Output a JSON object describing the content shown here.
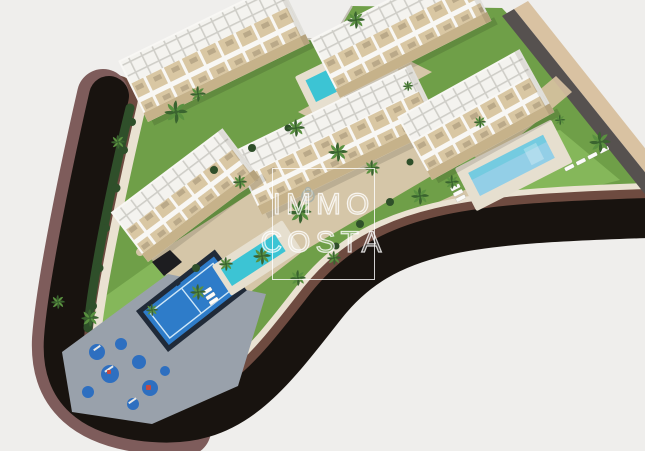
{
  "watermark": {
    "line1": "IMMO",
    "line2": "COSTA"
  },
  "palette": {
    "background": "#efeeec",
    "road-asphalt": "#18130f",
    "curb-maroon": "#7e5c5b",
    "curb-brown": "#6e4b40",
    "sidewalk-cream": "#eae2d2",
    "lawn-green": "#6f9f48",
    "lawn-light": "#85b75a",
    "hedge-dark": "#2f4f2a",
    "building-white": "#f8f7f4",
    "terrace-tan": "#d9c7a3",
    "stone-base": "#c6b28a",
    "plaza-tan": "#d5c6a8",
    "deck-cream": "#e6dfcf",
    "paving-gray": "#99a1ab",
    "pool-turquoise": "#3cc4d4",
    "pool-light": "#93cfe7",
    "padel-blue": "#2e7cc9",
    "padel-frame": "#202a38",
    "play-circle-blue": "#2e6fc0",
    "palm-dark": "#3a642f",
    "palm-light": "#5a9140",
    "trunk-brown": "#8a6a4c",
    "wall-dark": "#56514f",
    "wall-tan": "#d9c2a2"
  },
  "scene": {
    "setting": "aerial-3d-architectural-render",
    "features": [
      "apartment-blocks",
      "rooftop-terraces",
      "swimming-pools",
      "padel-court",
      "outdoor-gym-playground",
      "palm-trees",
      "perimeter-road",
      "lawns"
    ],
    "counts": {
      "apartment_blocks": 5,
      "swimming_pools": 3,
      "padel_courts": 1
    }
  }
}
